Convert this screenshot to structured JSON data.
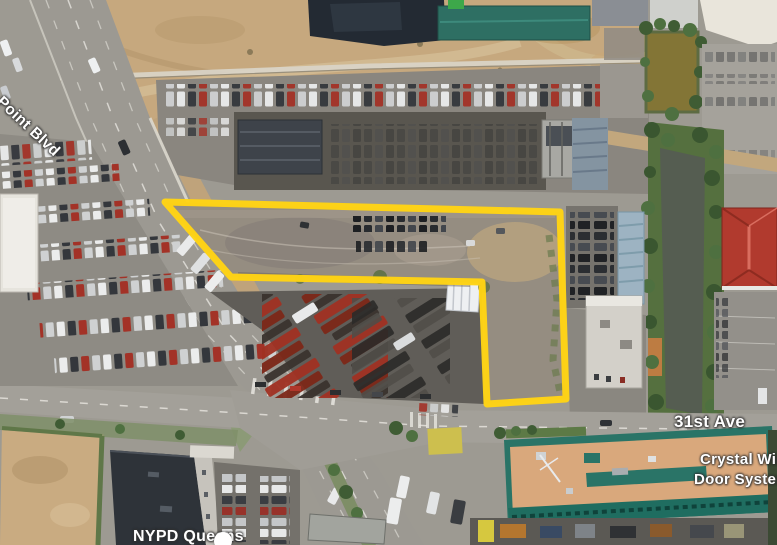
{
  "map": {
    "type": "satellite-aerial-view",
    "labels": {
      "road_blvd": "e Point Blvd",
      "street_31st": "31st Ave",
      "business_line1": "Crystal Window",
      "business_line2": "Door Systems",
      "poi_nypd": "NYPD Queens"
    },
    "parcel": {
      "points": "165,202 560,212 566,399 487,404 482,282 231,277",
      "outline_color": "#ffd414",
      "stroke_width": "7"
    },
    "colors": {
      "label_text": "#ffffff",
      "label_halo": "#3c3c3c",
      "dirt": "#c6a87e",
      "asphalt": "#8b8781",
      "road": "#9c9992",
      "creek_green": "#55703f",
      "creek_water": "#555d51",
      "pond_water": "#837536",
      "red_roof": "#b13a2e",
      "teal_roof": "#2e6f63",
      "crystal_roof": "#d9a87c",
      "crystal_trim": "#2a7467",
      "parcel_ground": "#958d81"
    }
  }
}
